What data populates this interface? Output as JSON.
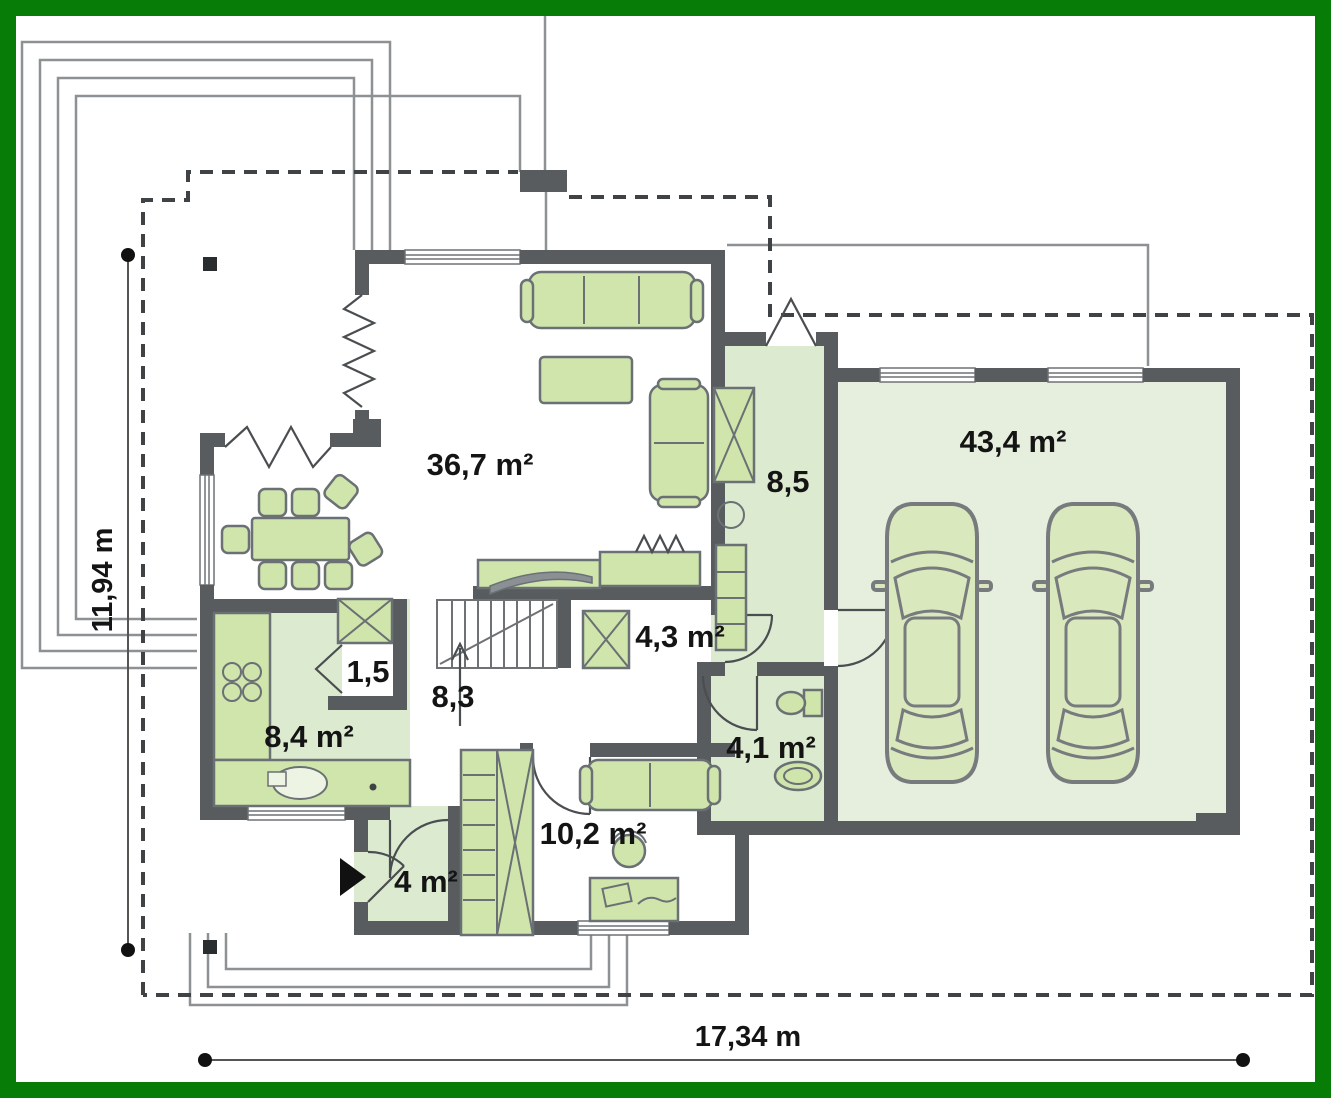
{
  "type": "floor-plan",
  "rooms": [
    {
      "name": "living-room",
      "label": "36,7 m²"
    },
    {
      "name": "corridor",
      "label": "8,5"
    },
    {
      "name": "garage",
      "label": "43,4 m²"
    },
    {
      "name": "wardrobe",
      "label": "4,3 m²"
    },
    {
      "name": "pantry",
      "label": "1,5"
    },
    {
      "name": "hall-stairs",
      "label": "8,3"
    },
    {
      "name": "kitchen",
      "label": "8,4 m²"
    },
    {
      "name": "bathroom",
      "label": "4,1 m²"
    },
    {
      "name": "office",
      "label": "10,2 m²"
    },
    {
      "name": "entry",
      "label": "4 m²"
    }
  ],
  "dimensions": {
    "height": "11,94 m",
    "width": "17,34 m"
  },
  "colors": {
    "frame": "#077d07",
    "walls": "#585c5f",
    "room_floor": "#dcead0",
    "garage_floor": "#e6efdd",
    "furniture": "#cfe5ab",
    "outline": "#8d9194"
  }
}
